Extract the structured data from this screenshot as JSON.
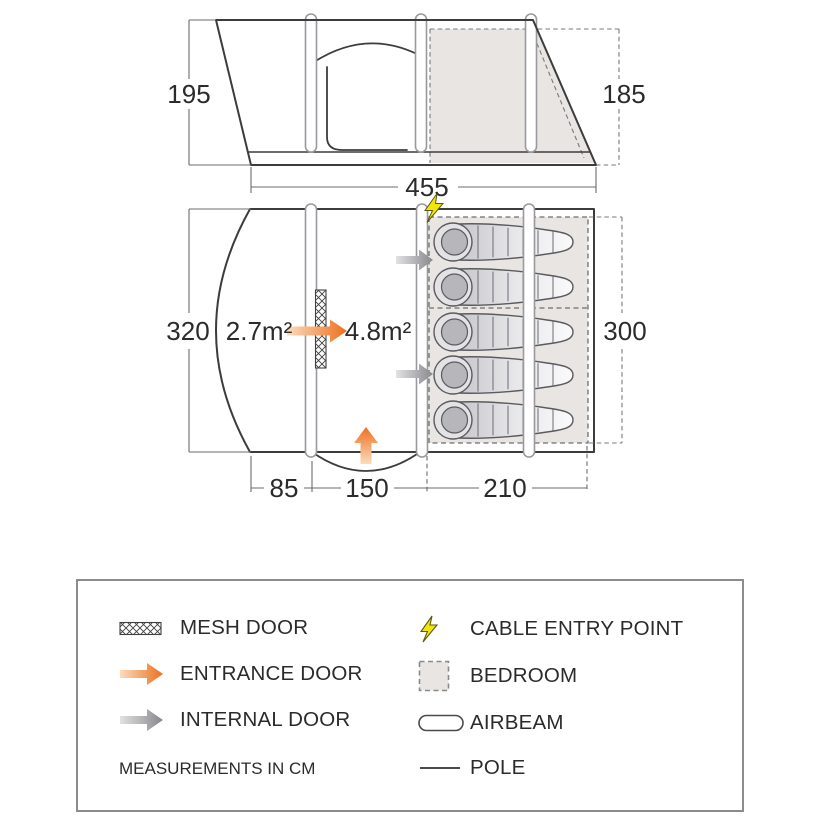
{
  "figure": {
    "side_view": {
      "left_height": "195",
      "right_height": "185"
    },
    "total_width": "455",
    "floor_plan": {
      "left_depth": "320",
      "bedroom_depth": "300",
      "porch_area": "2.7m²",
      "living_area": "4.8m²",
      "porch_width": "85",
      "living_width": "150",
      "bedroom_width": "210",
      "sleeping_bag_count": 5
    }
  },
  "legend": {
    "items": [
      {
        "id": "mesh-door",
        "label": "MESH DOOR"
      },
      {
        "id": "entrance-door",
        "label": "ENTRANCE DOOR"
      },
      {
        "id": "internal-door",
        "label": "INTERNAL DOOR"
      },
      {
        "id": "cable-entry-point",
        "label": "CABLE ENTRY POINT"
      },
      {
        "id": "bedroom",
        "label": "BEDROOM"
      },
      {
        "id": "airbeam",
        "label": "AIRBEAM"
      },
      {
        "id": "pole",
        "label": "POLE"
      }
    ],
    "note": "MEASUREMENTS IN CM"
  },
  "colors": {
    "outline": "#3c3c3c",
    "dimension_line": "#6b6b6b",
    "text": "#2b2b2b",
    "bedroom_fill": "#e8e5e2",
    "entrance_orange": "#ed6f1f",
    "internal_gray": "#88888d",
    "cable_yellow": "#f2e50a"
  }
}
